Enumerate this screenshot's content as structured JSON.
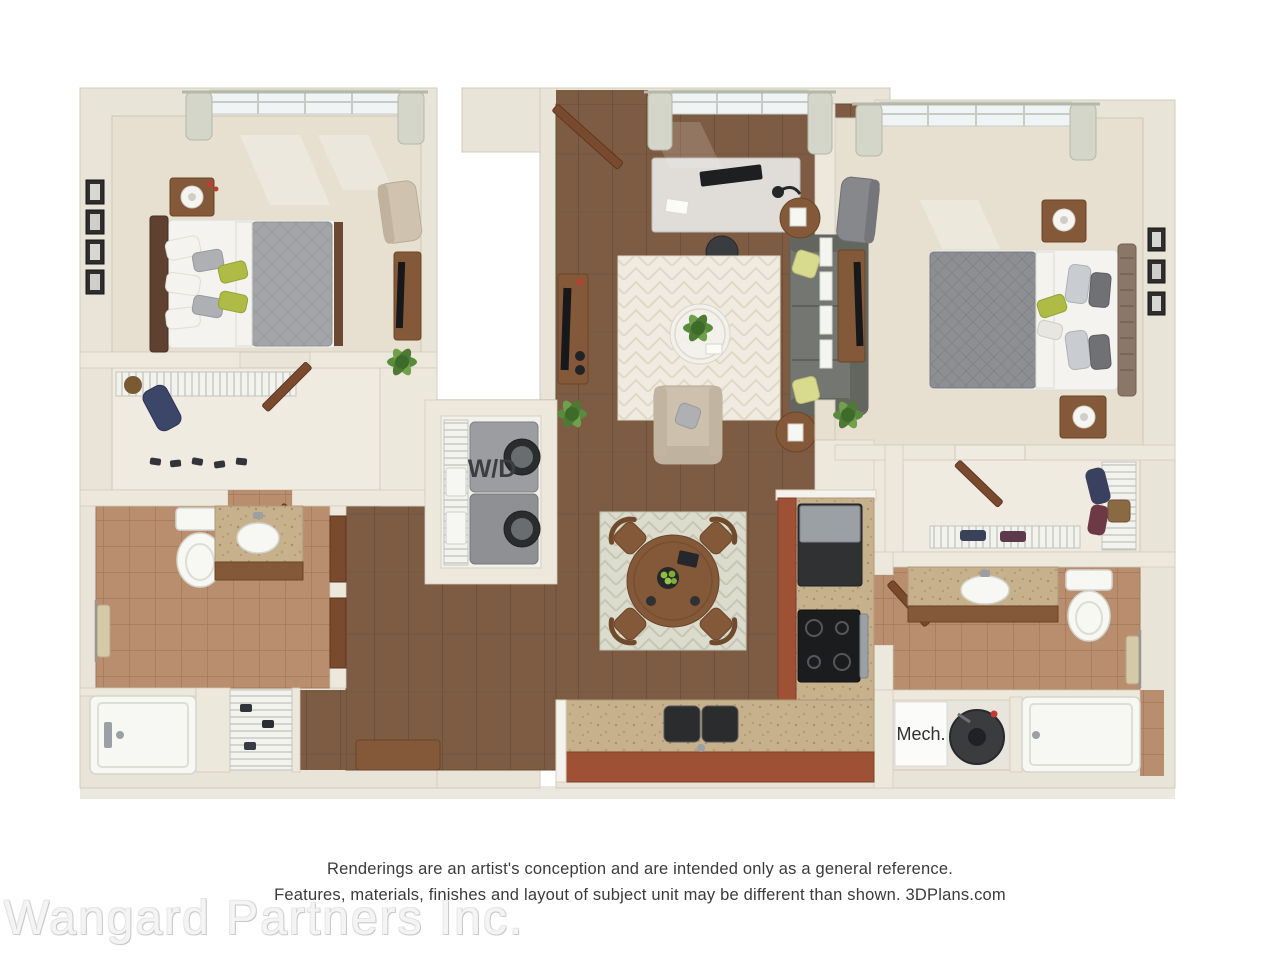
{
  "scene": {
    "type": "3D top-down floor plan rendering",
    "rooms_depicted": [
      "bedroom-left",
      "closet-left",
      "bathroom-left",
      "shower-left",
      "laundry-closet",
      "living-room",
      "dining-area",
      "kitchen",
      "hallway",
      "bedroom-right",
      "walk-in-closet-right",
      "bathroom-right",
      "mechanical-closet",
      "bathtub-right"
    ]
  },
  "unit_labels": {
    "laundry": "W/D",
    "mechanical": "Mech."
  },
  "footer": {
    "disclaimer_line1": "Renderings are an artist's conception and are intended only as a general reference.",
    "disclaimer_line2": "Features, materials, finishes and layout of subject unit may be different than shown. 3DPlans.com",
    "watermark": "Wangard Partners Inc."
  },
  "palette": {
    "background": "#FFFFFF",
    "wall_cream": "#E9E4D8",
    "wood_floor": "#7E5C43",
    "carpet_beige": "#E7E0D1",
    "bath_tile": "#B98E6E",
    "granite_counter": "#C7B08C",
    "kitchen_cabinet_terracotta": "#9E5134",
    "door_wood": "#7A4A2E",
    "sofa_gray": "#747771",
    "accent_green": "#AEBB45",
    "appliance_dark": "#2A2C2E",
    "washer_gray": "#9B9DA0",
    "fixture_white": "#F7F7F4",
    "curtain_sage": "#D3D6C8",
    "disclaimer_text": "#3B3B3B",
    "watermark_gray": "#DEDEDE"
  }
}
